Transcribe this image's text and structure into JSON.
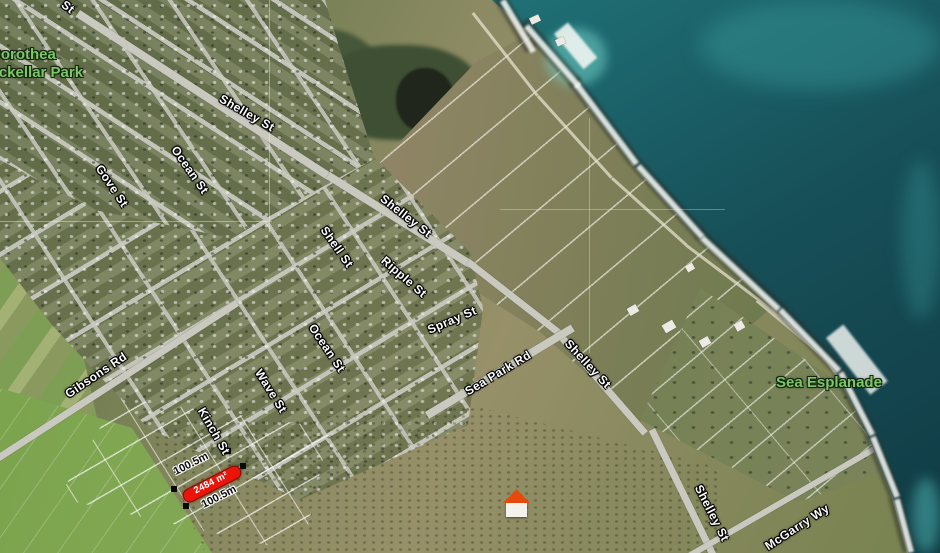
{
  "map": {
    "description": "Satellite map of a coastal town with a highlighted for-sale land parcel",
    "colors": {
      "ocean_deep": "#113b44",
      "ocean": "#1f6f75",
      "ocean_shallow": "#3aa7a4",
      "land": "#8a8a62",
      "field_green": "#7da24f",
      "road": "#c9c9c0",
      "street_label": "#ffffff",
      "park_label": "#7cc768",
      "parcel_red": "#ea1508",
      "vertex_marker": "#0a0a0a"
    }
  },
  "labels": {
    "streets": [
      {
        "text": "St",
        "x": 68,
        "y": 7,
        "rot": 38
      },
      {
        "text": "Shelley St",
        "x": 247,
        "y": 113,
        "rot": 30
      },
      {
        "text": "Shelley St",
        "x": 406,
        "y": 216,
        "rot": 38
      },
      {
        "text": "Gove St",
        "x": 112,
        "y": 186,
        "rot": 56
      },
      {
        "text": "Ocean St",
        "x": 190,
        "y": 170,
        "rot": 55
      },
      {
        "text": "Shell St",
        "x": 337,
        "y": 247,
        "rot": 55
      },
      {
        "text": "Ripple St",
        "x": 404,
        "y": 277,
        "rot": 41
      },
      {
        "text": "Ocean St",
        "x": 327,
        "y": 348,
        "rot": 56
      },
      {
        "text": "Spray St",
        "x": 452,
        "y": 320,
        "rot": -23
      },
      {
        "text": "Sea Park Rd",
        "x": 498,
        "y": 373,
        "rot": -31
      },
      {
        "text": "Gibsons Rd",
        "x": 96,
        "y": 375,
        "rot": -34
      },
      {
        "text": "Wave St",
        "x": 271,
        "y": 391,
        "rot": 58
      },
      {
        "text": "Kinch St",
        "x": 214,
        "y": 431,
        "rot": 60
      },
      {
        "text": "Shelley St",
        "x": 588,
        "y": 364,
        "rot": 47
      },
      {
        "text": "Shelley St",
        "x": 712,
        "y": 513,
        "rot": 63
      },
      {
        "text": "McGarry Wy",
        "x": 797,
        "y": 527,
        "rot": -33
      }
    ],
    "parks": [
      {
        "lines": [
          "Dorothea",
          "Mackellar Park"
        ]
      },
      {
        "lines": [
          "Sea Esplanade"
        ]
      }
    ]
  },
  "parcel": {
    "area_label": "2484 m²",
    "dim_top": "100.5m",
    "dim_bottom": "100.5m"
  }
}
